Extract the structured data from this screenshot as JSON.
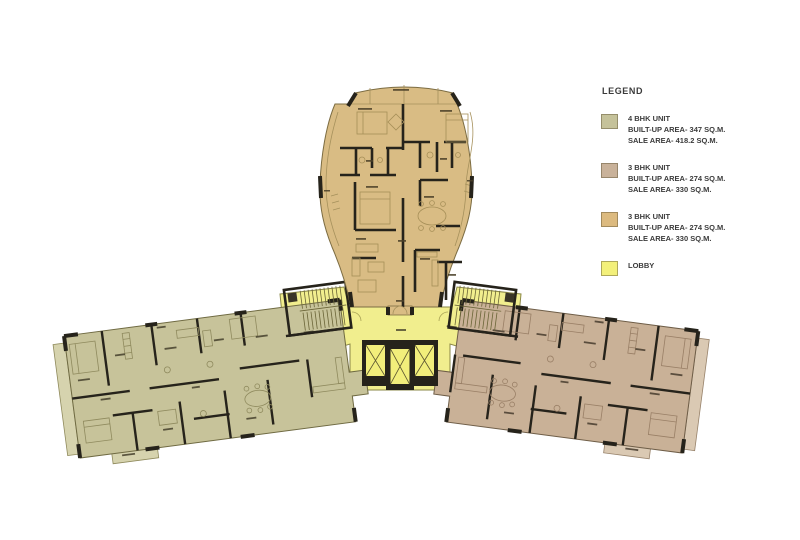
{
  "legend": {
    "title": "LEGEND",
    "entries": [
      {
        "label": "4 BHK UNIT",
        "line2": "BUILT-UP AREA- 347 SQ.M.",
        "line3": "SALE AREA- 418.2 SQ.M.",
        "color": "#c5c29a"
      },
      {
        "label": "3 BHK UNIT",
        "line2": "BUILT-UP AREA- 274 SQ.M.",
        "line3": "SALE AREA- 330 SQ.M.",
        "color": "#c9b29a"
      },
      {
        "label": "3 BHK UNIT",
        "line2": "BUILT-UP AREA- 274 SQ.M.",
        "line3": "SALE AREA- 330 SQ.M.",
        "color": "#dcba7f"
      },
      {
        "label": "LOBBY",
        "line2": "",
        "line3": "",
        "color": "#f3f07a"
      }
    ]
  },
  "plan": {
    "units": [
      {
        "id": "left-wing",
        "type": "4 BHK UNIT"
      },
      {
        "id": "right-wing",
        "type": "3 BHK UNIT"
      },
      {
        "id": "top-wing",
        "type": "3 BHK UNIT"
      },
      {
        "id": "core",
        "type": "LOBBY"
      }
    ],
    "colors": {
      "unit_top": "#d9bc84",
      "unit_left": "#c7c39a",
      "unit_right": "#c9b197",
      "balcony_left": "#d6d3ae",
      "balcony_right": "#dac9b3",
      "lobby": "#f1ee8e",
      "stair": "#f5f17e",
      "lift": "#f2ee7b",
      "wall": "#26231b"
    }
  }
}
